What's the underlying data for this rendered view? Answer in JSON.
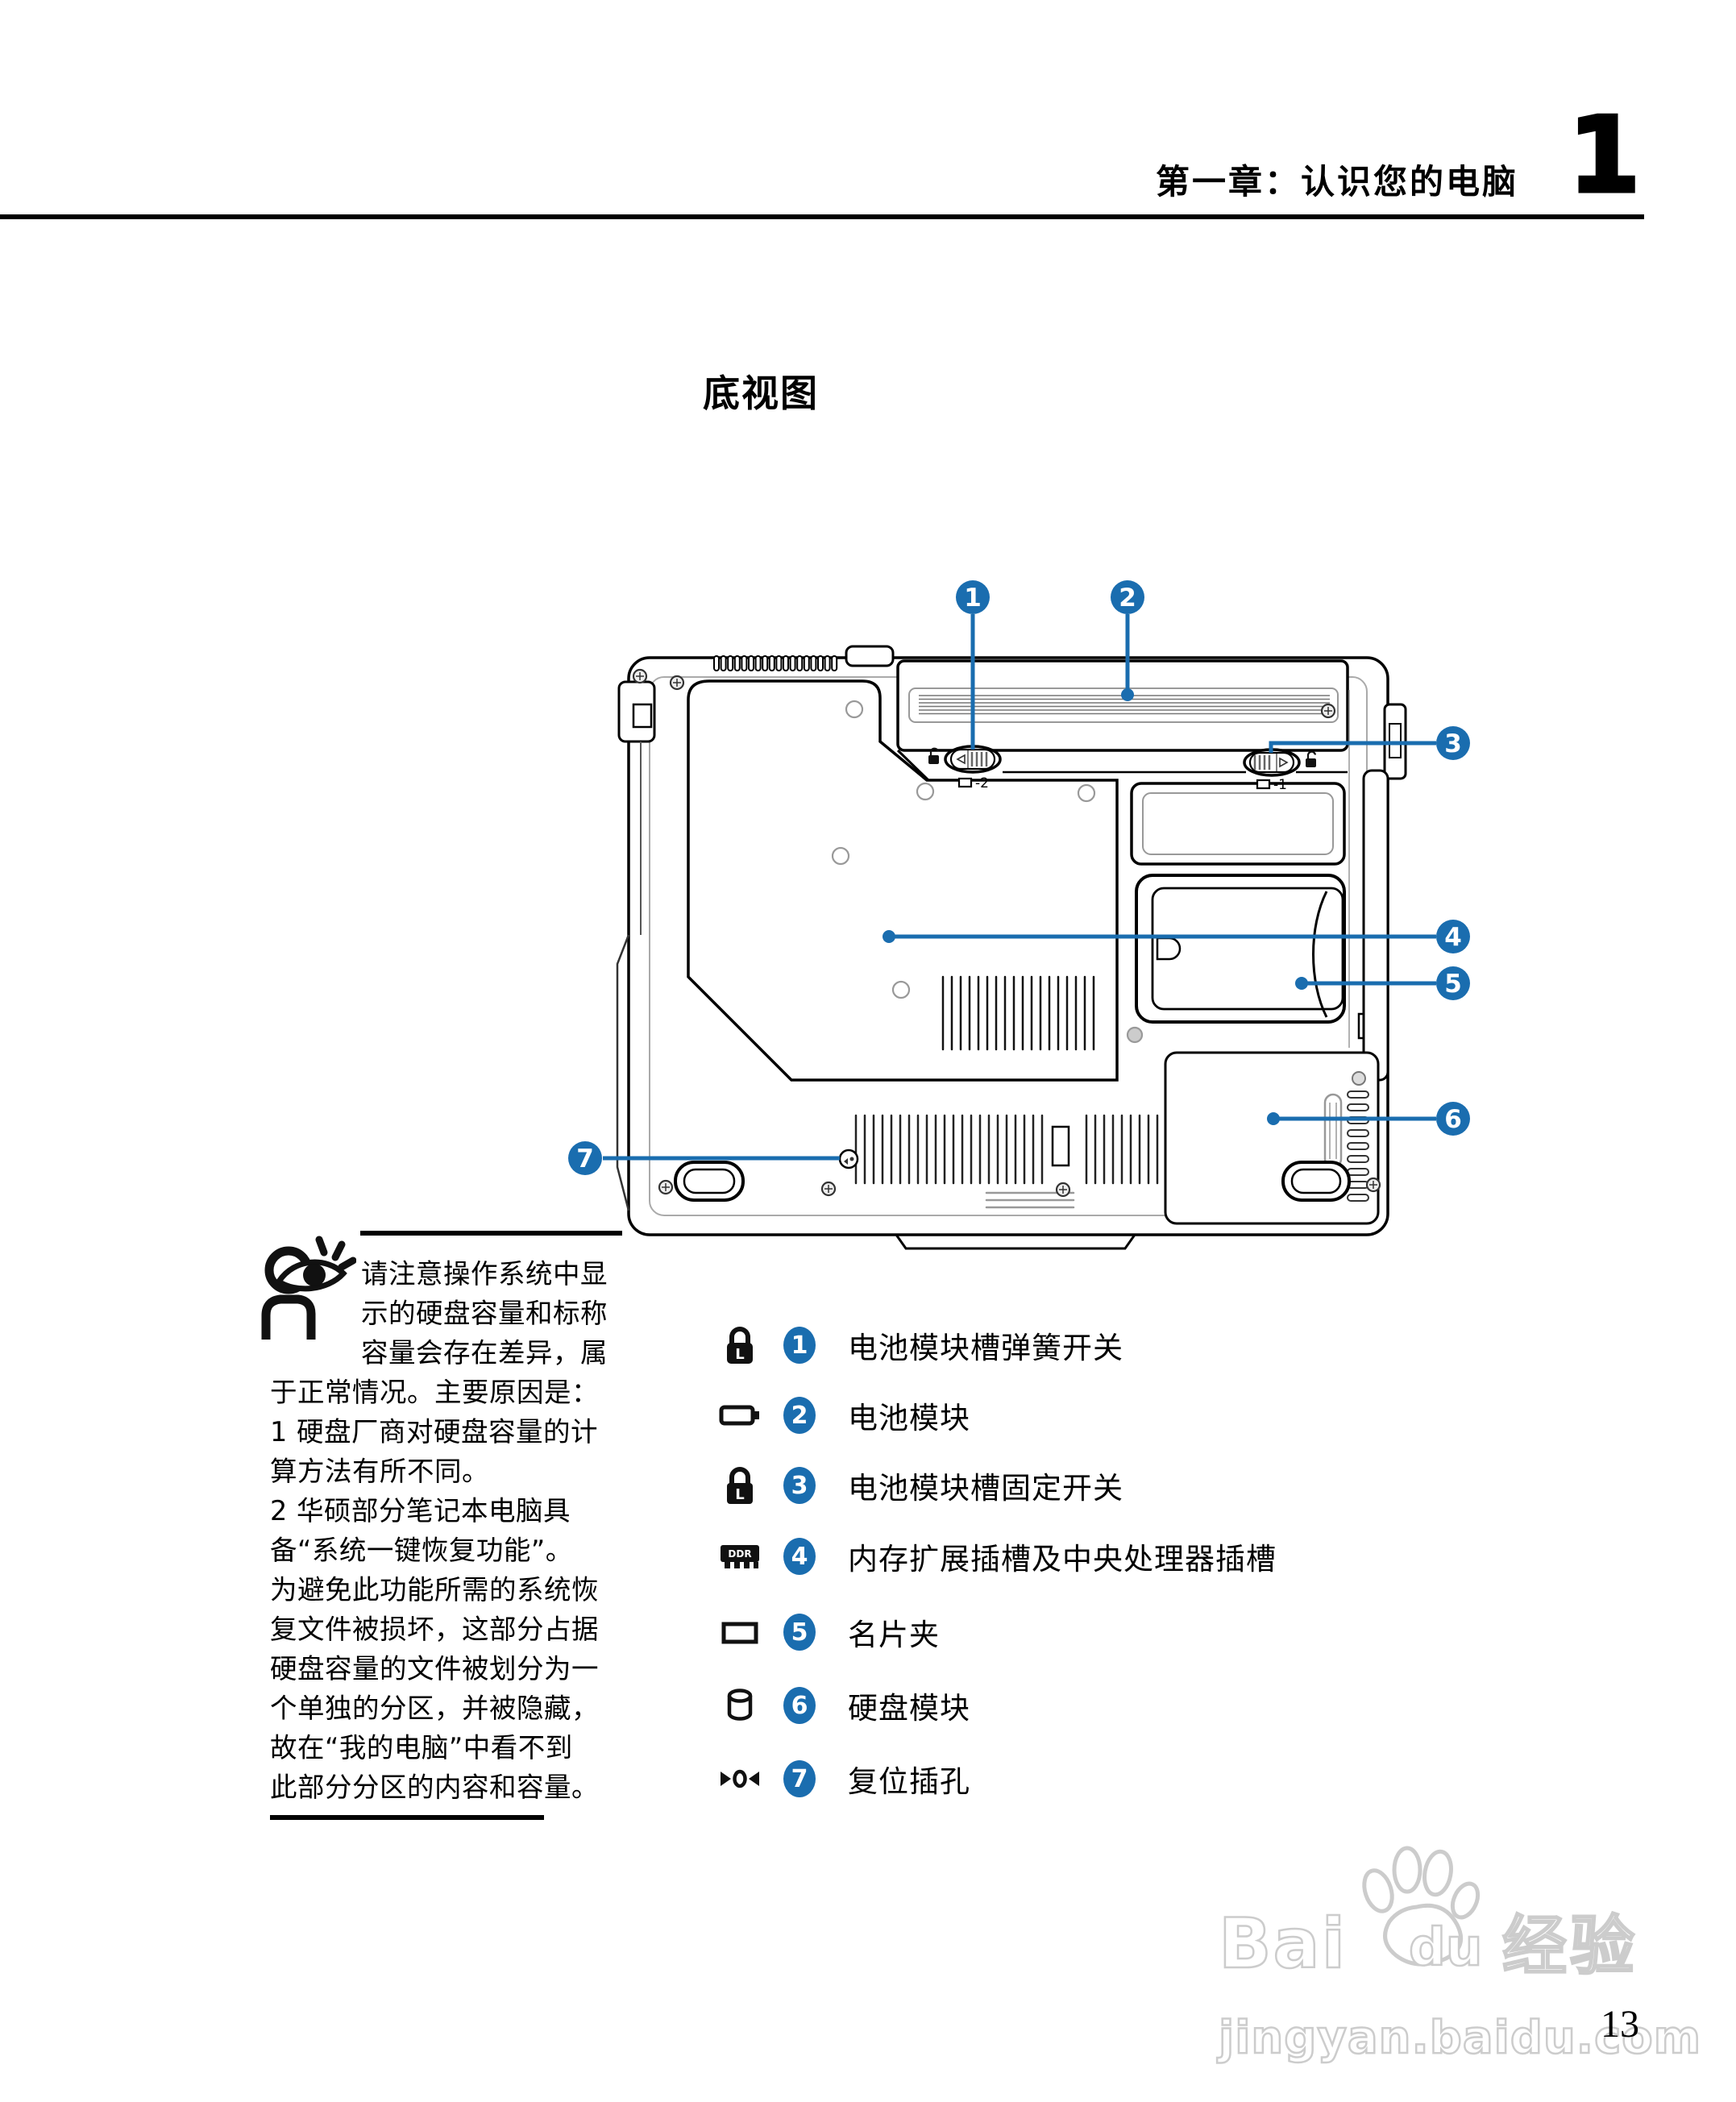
{
  "header": {
    "chapter_title": "第一章：认识您的电脑",
    "chapter_number": "1"
  },
  "section": {
    "title": "底视图"
  },
  "diagram": {
    "callouts": [
      {
        "num": "1"
      },
      {
        "num": "2"
      },
      {
        "num": "3"
      },
      {
        "num": "4"
      },
      {
        "num": "5"
      },
      {
        "num": "6"
      },
      {
        "num": "7"
      }
    ],
    "latch_left_label": "-2",
    "latch_right_label": "-1"
  },
  "note": {
    "lines": [
      "请注意操作系统中显",
      "示的硬盘容量和标称",
      "容量会存在差异，属",
      "于正常情况。主要原因是：",
      "1 硬盘厂商对硬盘容量的计",
      "算方法有所不同。",
      "2 华硕部分笔记本电脑具",
      "备“系统一键恢复功能”。",
      "为避免此功能所需的系统恢",
      "复文件被损坏，这部分占据",
      "硬盘容量的文件被划分为一",
      "个单独的分区，并被隐藏，",
      "故在“我的电脑”中看不到",
      "此部分分区的内容和容量。"
    ]
  },
  "legend": {
    "items": [
      {
        "num": "1",
        "icon": "lock-icon",
        "icon_text": "L",
        "label": "电池模块槽弹簧开关"
      },
      {
        "num": "2",
        "icon": "battery-icon",
        "icon_text": "",
        "label": "电池模块"
      },
      {
        "num": "3",
        "icon": "lock-icon",
        "icon_text": "L",
        "label": "电池模块槽固定开关"
      },
      {
        "num": "4",
        "icon": "ram-icon",
        "icon_text": "DDR",
        "label": "内存扩展插槽及中央处理器插槽"
      },
      {
        "num": "5",
        "icon": "card-icon",
        "icon_text": "",
        "label": "名片夹"
      },
      {
        "num": "6",
        "icon": "harddisk-icon",
        "icon_text": "",
        "label": "硬盘模块"
      },
      {
        "num": "7",
        "icon": "reset-icon",
        "icon_text": "",
        "label": "复位插孔"
      }
    ]
  },
  "footer": {
    "page_number": "13",
    "watermark": {
      "brand_prefix": "Bai",
      "brand_suffix": "du",
      "brand_cn": "经验",
      "url": "jingyan.baidu.com"
    }
  },
  "colors": {
    "callout_blue": "#1a6daf",
    "line_black": "#000000",
    "watermark_gray": "#cccccc"
  }
}
